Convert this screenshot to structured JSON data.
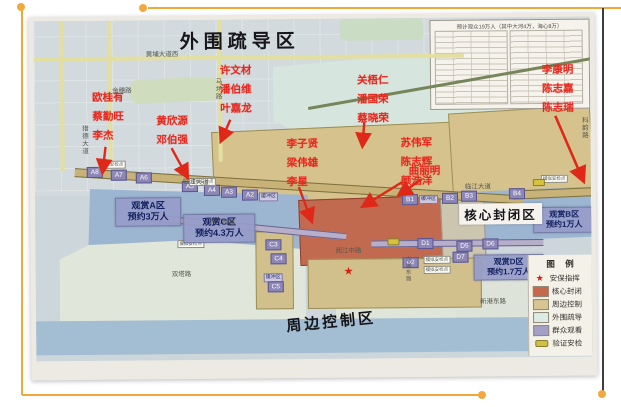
{
  "accent_color": "#f2a93b",
  "map": {
    "titles": {
      "outer_zone": "外围疏导区",
      "core_zone": "核心封闭区",
      "perimeter_zone": "周边控制区"
    },
    "viewing_labels": [
      {
        "name": "观赏A区",
        "capacity": "预约3万人"
      },
      {
        "name": "观赏C区",
        "capacity": "预约4.3万人"
      },
      {
        "name": "观赏B区",
        "capacity": "预约1万人"
      },
      {
        "name": "观赏D区",
        "capacity": "预约1.7万人"
      }
    ],
    "name_groups": [
      {
        "names": [
          "欧桂有",
          "蔡勤旺",
          "李杰"
        ]
      },
      {
        "names": [
          "黄欣源",
          "邓伯强"
        ]
      },
      {
        "names": [
          "许文材",
          "潘伯维",
          "叶嘉龙"
        ]
      },
      {
        "names": [
          "李子贤",
          "梁伟雄",
          "李星"
        ]
      },
      {
        "names": [
          "关梧仁",
          "潘国荣",
          "蔡晓荣"
        ]
      },
      {
        "names": [
          "苏伟军",
          "陈志辉",
          "颜浩洋"
        ]
      },
      {
        "names": [
          "曲丽明"
        ]
      },
      {
        "names": [
          "李康明",
          "陈志嘉",
          "陈志瑞"
        ]
      }
    ],
    "roads": {
      "huangpu": "黄埔大道西",
      "jinsui": "金穗路",
      "machang": "马场路",
      "liede": "猎德大道",
      "keyun": "科韵路",
      "linjiang_w": "临江大道",
      "linjiang_e": "临江大道",
      "yuejiang_w": "阅江西路",
      "yuejiang_m": "阅江中路",
      "xingang": "新港东路",
      "shuangta": "双塔路",
      "huizhan": "会展东路"
    },
    "markers": {
      "a": [
        "A8",
        "A7",
        "A6",
        "A5",
        "A4",
        "A3",
        "A2"
      ],
      "b": [
        "B1",
        "B2",
        "B3",
        "B4"
      ],
      "c": [
        "C3",
        "C4",
        "C5"
      ],
      "d": [
        "D1",
        "D5",
        "D6",
        "D7",
        "D2"
      ]
    },
    "buffer_label": "缓冲区",
    "checkpoint_label": "模拟安检点",
    "stats_table": {
      "title": "预计观众19万人（其中大河4万，海心8万）"
    },
    "legend": {
      "title": "图  例",
      "items": [
        {
          "label": "安保指挥",
          "swatch": "star",
          "glyph": "★",
          "color": "#d81e12"
        },
        {
          "label": "核心封闭",
          "swatch": "rect",
          "color": "#c4694e"
        },
        {
          "label": "周边控制",
          "swatch": "rect",
          "color": "#d8c491"
        },
        {
          "label": "外围疏导",
          "swatch": "rect",
          "color": "#dcebe4"
        },
        {
          "label": "群众观看",
          "swatch": "rect",
          "color": "#a39fc6"
        },
        {
          "label": "验证安检",
          "swatch": "pill",
          "color": "#cfc04a"
        }
      ]
    }
  }
}
